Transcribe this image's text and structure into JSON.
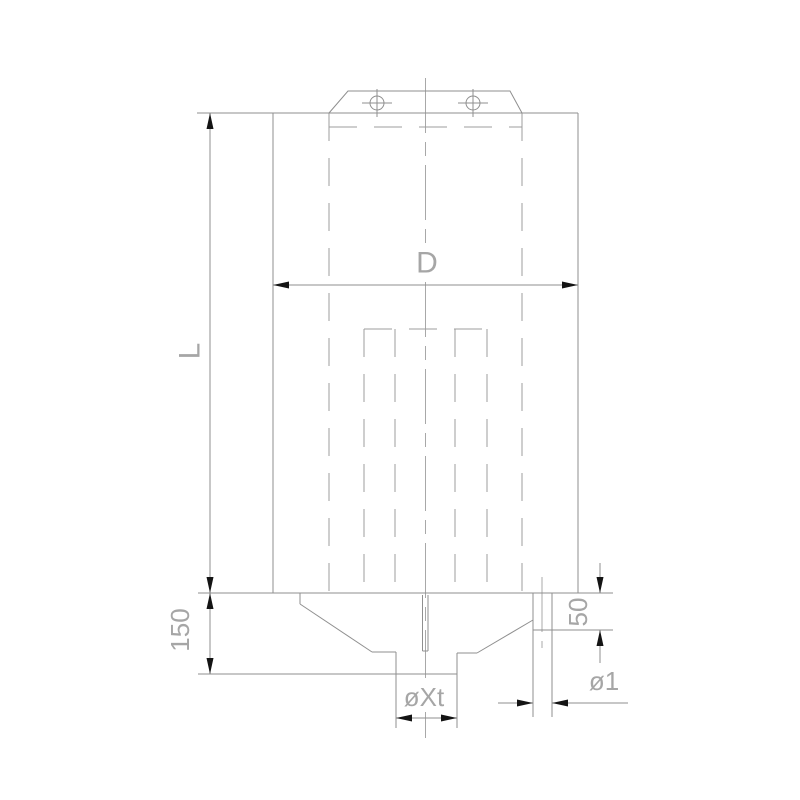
{
  "drawing": {
    "kind": "technical-drawing",
    "labels": {
      "length": "L",
      "diameter": "D",
      "bottom_height": "150",
      "outlet_height": "50",
      "spout_diameter": "øXt",
      "outlet_diameter": "ø1"
    },
    "colors": {
      "background": "#ffffff",
      "line": "#8f8f8f",
      "line_light": "#9c9c9c",
      "centerline": "#a8a8a8",
      "text": "#a6a6a6",
      "arrow": "#141414"
    }
  }
}
